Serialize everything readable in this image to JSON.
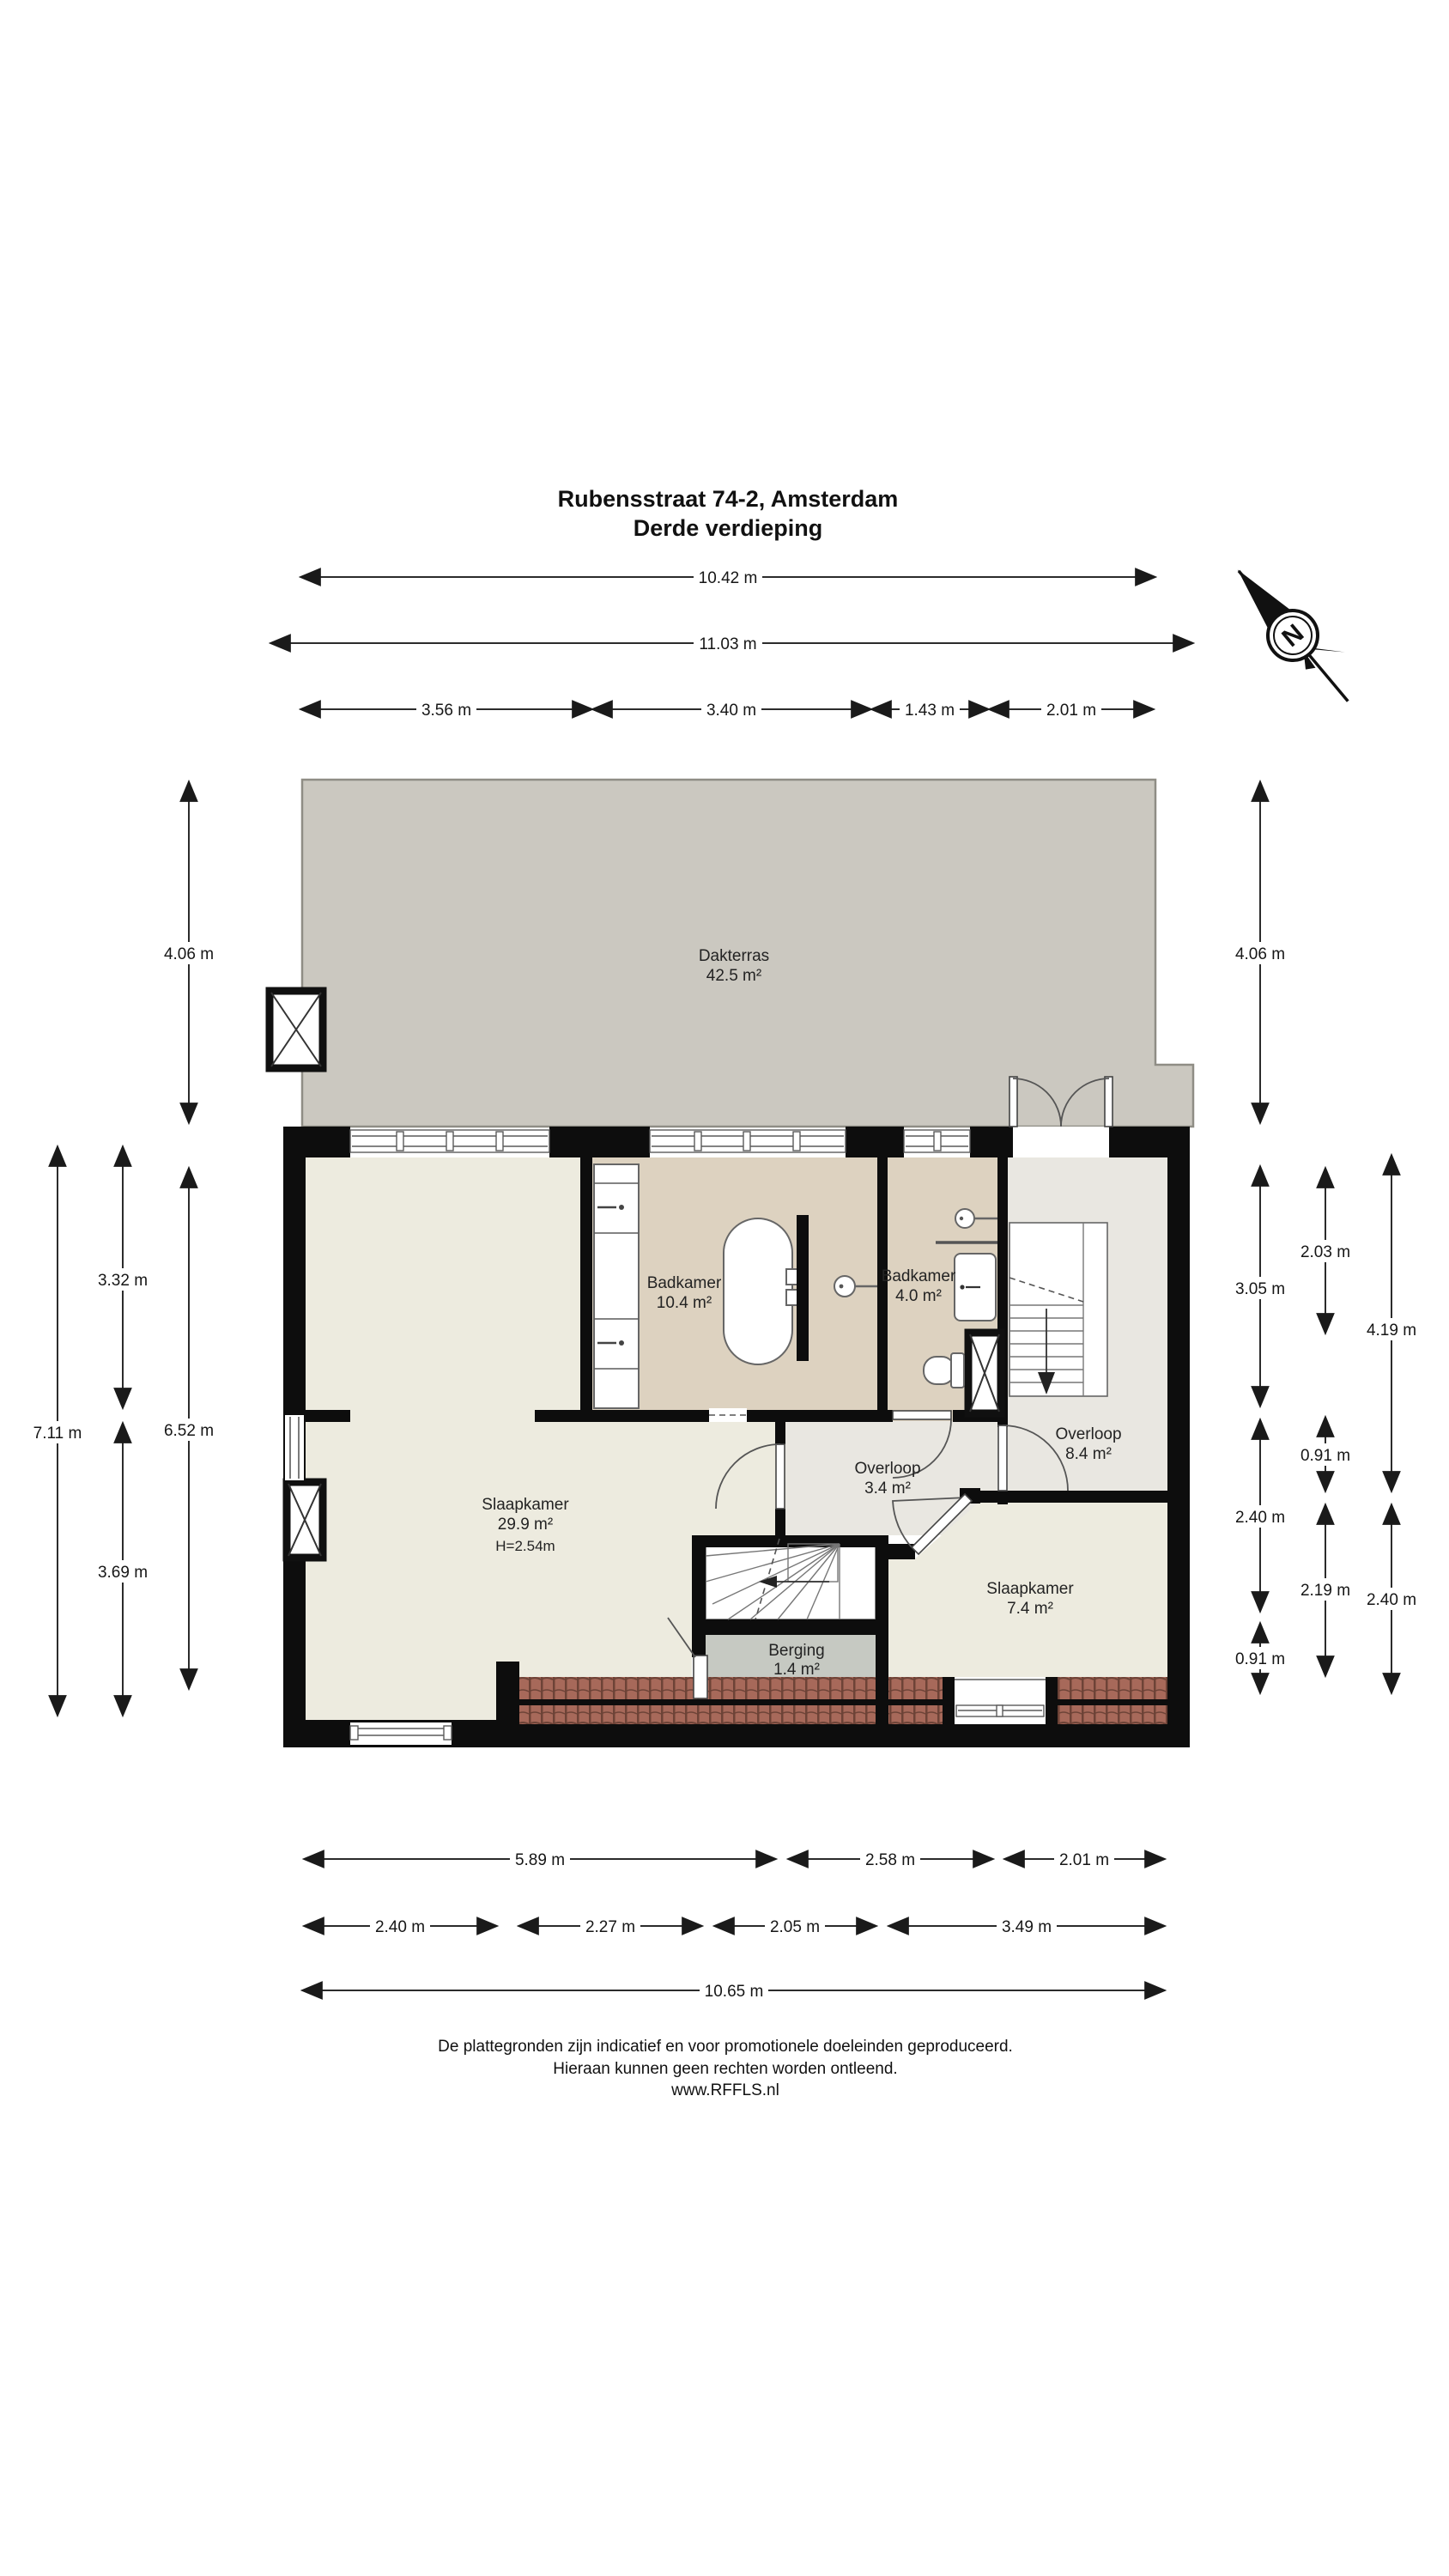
{
  "title": {
    "line1": "Rubensstraat 74-2, Amsterdam",
    "line2": "Derde verdieping"
  },
  "compass": {
    "letter": "N"
  },
  "rooms": {
    "dakterras": {
      "name": "Dakterras",
      "area": "42.5 m²"
    },
    "badkamer_groot": {
      "name": "Badkamer",
      "area": "10.4 m²"
    },
    "badkamer_klein": {
      "name": "Badkamer",
      "area": "4.0 m²"
    },
    "overloop_groot": {
      "name": "Overloop",
      "area": "8.4 m²"
    },
    "overloop_klein": {
      "name": "Overloop",
      "area": "3.4 m²"
    },
    "slaapkamer_groot": {
      "name": "Slaapkamer",
      "area": "29.9 m²",
      "ceiling_height": "H=2.54m"
    },
    "slaapkamer_klein": {
      "name": "Slaapkamer",
      "area": "7.4 m²"
    },
    "berging": {
      "name": "Berging",
      "area": "1.4 m²"
    }
  },
  "dims": {
    "top": {
      "t1": "10.42 m",
      "t2": "11.03 m",
      "t3": "3.56 m",
      "t4": "3.40 m",
      "t5": "1.43 m",
      "t6": "2.01 m"
    },
    "bottom": {
      "b1": "5.89 m",
      "b2": "2.58 m",
      "b3": "2.01 m",
      "b4": "2.40 m",
      "b5": "2.27 m",
      "b6": "2.05 m",
      "b7": "3.49 m",
      "b8": "10.65 m"
    },
    "left": {
      "l1": "4.06 m",
      "l2": "3.32 m",
      "l3": "3.69 m",
      "l4": "7.11 m",
      "l5": "6.52 m"
    },
    "right": {
      "r1": "4.06 m",
      "r2": "3.05 m",
      "r3": "2.40 m",
      "r4": "0.91 m",
      "r5": "2.03 m",
      "r6": "0.91 m",
      "r7": "2.19 m",
      "r8": "4.19 m",
      "r9": "2.40 m"
    }
  },
  "footer": {
    "line1": "De plattegronden zijn indicatief en voor promotionele doeleinden geproduceerd.",
    "line2": "Hieraan kunnen geen rechten worden ontleend.",
    "line3": "www.RFFLS.nl"
  },
  "colors": {
    "wall": "#0d0d0d",
    "floor_main": "#edebdf",
    "bathroom": "#ddd2c0",
    "hallway": "#e9e7e1",
    "storage": "#c6c9c2",
    "terrace": "#cbc8c0",
    "tiles": "#a7695a",
    "tiles_dark": "#6d4337"
  }
}
